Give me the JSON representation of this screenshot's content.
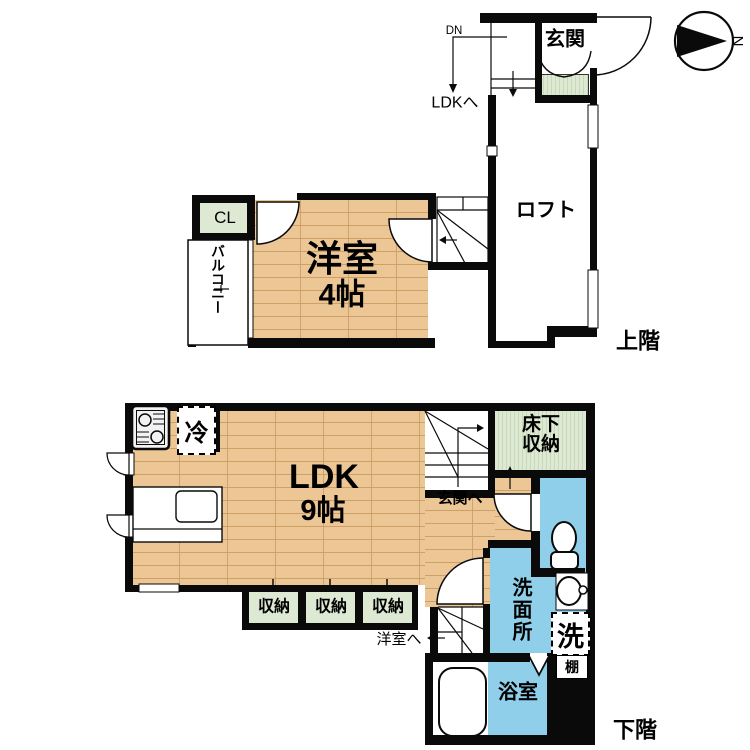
{
  "compass": {
    "north_label": "N"
  },
  "colors": {
    "wood_floor": "#ecc795",
    "wood_plank_line": "#cfa066",
    "green_floor": "#dde9d3",
    "green_stripe": "#c7d9b6",
    "water_blue": "#90cfe9",
    "wall": "#0a0a0a"
  },
  "upper_floor": {
    "floor_label": "上階",
    "genkan_label": "玄関",
    "loft_label": "ロフト",
    "room_label": "洋室",
    "room_size": "4帖",
    "closet_label": "CL",
    "balcony_label": "バルコニー",
    "stairs_down_label": "DN",
    "to_ldk_label": "LDKへ"
  },
  "lower_floor": {
    "floor_label": "下階",
    "ldk_label": "LDK",
    "ldk_size": "9帖",
    "fridge_label": "冷",
    "underfloor_storage_line1": "床下",
    "underfloor_storage_line2": "収納",
    "to_genkan_label": "玄関へ",
    "washroom_label": "洗面所",
    "laundry_label": "洗",
    "shelf_label": "棚",
    "bathroom_label": "浴室",
    "to_room_label": "洋室へ",
    "closets": [
      "収納",
      "収納",
      "収納"
    ]
  }
}
